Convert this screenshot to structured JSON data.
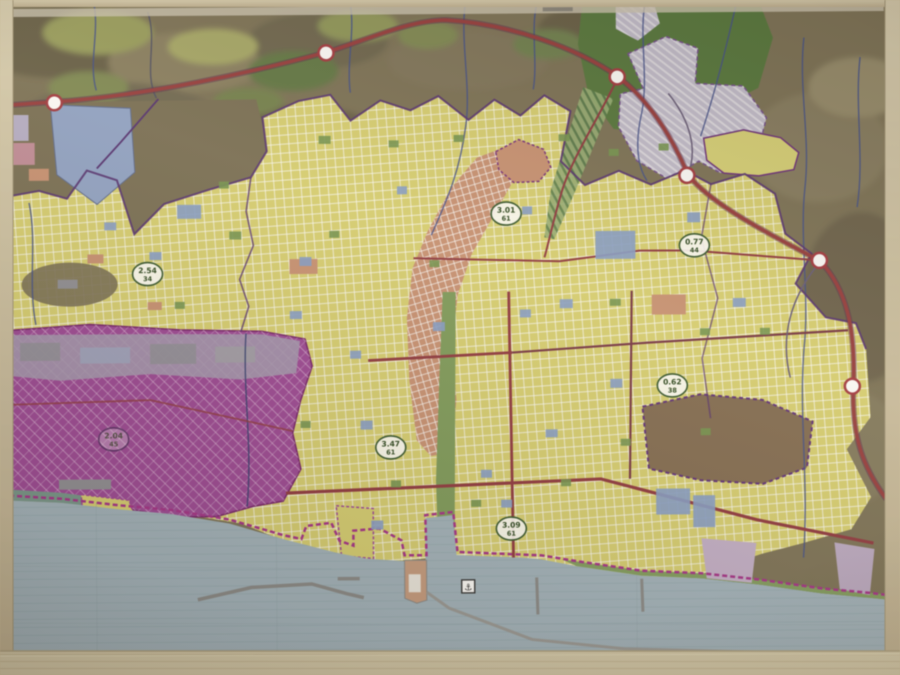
{
  "photo": {
    "description": "Photograph of a framed coastal city zoning / master-plan map",
    "frame_color": "#d2c49c"
  },
  "map": {
    "zone_colors": {
      "urban_residential": "#ded455",
      "city_center": "#d98e66",
      "industrial": "#b23ea8",
      "terrain_hills": "#80724c",
      "agriculture_green": "#4f7c2c",
      "protected_hatched": "#c3bdd4",
      "sea": "#9db6c3",
      "highway_red": "#b03434",
      "boundary_purple": "#5c2a80",
      "stream_blue": "#3c4e9c"
    },
    "density_labels": [
      {
        "value": "3.01",
        "sub": "61"
      },
      {
        "value": "2.54",
        "sub": "34"
      },
      {
        "value": "0.77",
        "sub": "44"
      },
      {
        "value": "0.62",
        "sub": "38"
      },
      {
        "value": "3.47",
        "sub": "61"
      },
      {
        "value": "3.09",
        "sub": "61"
      },
      {
        "value": "2.04",
        "sub": "45"
      }
    ],
    "icons": [
      {
        "name": "anchor-icon"
      },
      {
        "name": "road-junction-marker"
      }
    ]
  }
}
